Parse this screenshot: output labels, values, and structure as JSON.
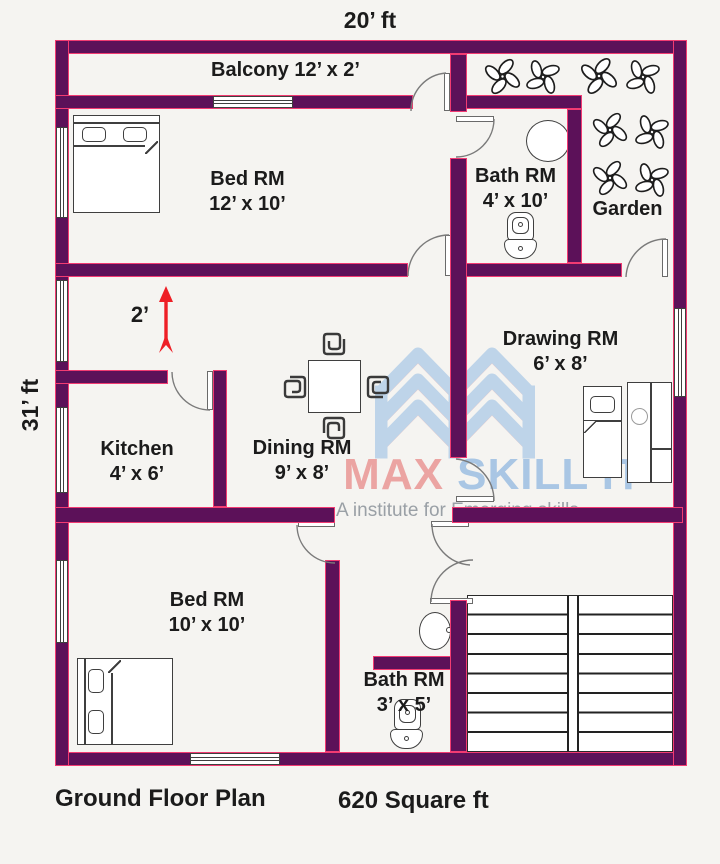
{
  "plan": {
    "top_dimension": "20’ ft",
    "left_dimension": "31’ ft",
    "corridor_dimension": "2’",
    "floor_title": "Ground Floor Plan",
    "area_label": "620 Square ft"
  },
  "rooms": {
    "balcony": {
      "name": "Balcony",
      "dims": "12’ x 2’"
    },
    "bed_top": {
      "name": "Bed RM",
      "dims": "12’ x 10’"
    },
    "bath_top": {
      "name": "Bath RM",
      "dims": "4’ x 10’"
    },
    "garden": {
      "name": "Garden"
    },
    "drawing": {
      "name": "Drawing RM",
      "dims": "6’ x 8’"
    },
    "kitchen": {
      "name": "Kitchen",
      "dims": "4’ x 6’"
    },
    "dining": {
      "name": "Dining RM",
      "dims": "9’ x 8’"
    },
    "bed_bottom": {
      "name": "Bed RM",
      "dims": "10’ x 10’"
    },
    "bath_bottom": {
      "name": "Bath RM",
      "dims": "3’ x 5’"
    }
  },
  "watermark": {
    "brand_first": "MAX",
    "brand_rest": " SKILL IT",
    "tagline": "A institute for Emerging skills"
  },
  "colors": {
    "background": "#f5f4f1",
    "wall_fill": "#5c1159",
    "wall_border": "#f23b72",
    "text": "#1b1b1b",
    "arrow_red": "#ee1f26",
    "brand_pink": "#eba4a2",
    "brand_blue": "#a9c6e4",
    "tagline_gray": "#9aa0a6"
  }
}
